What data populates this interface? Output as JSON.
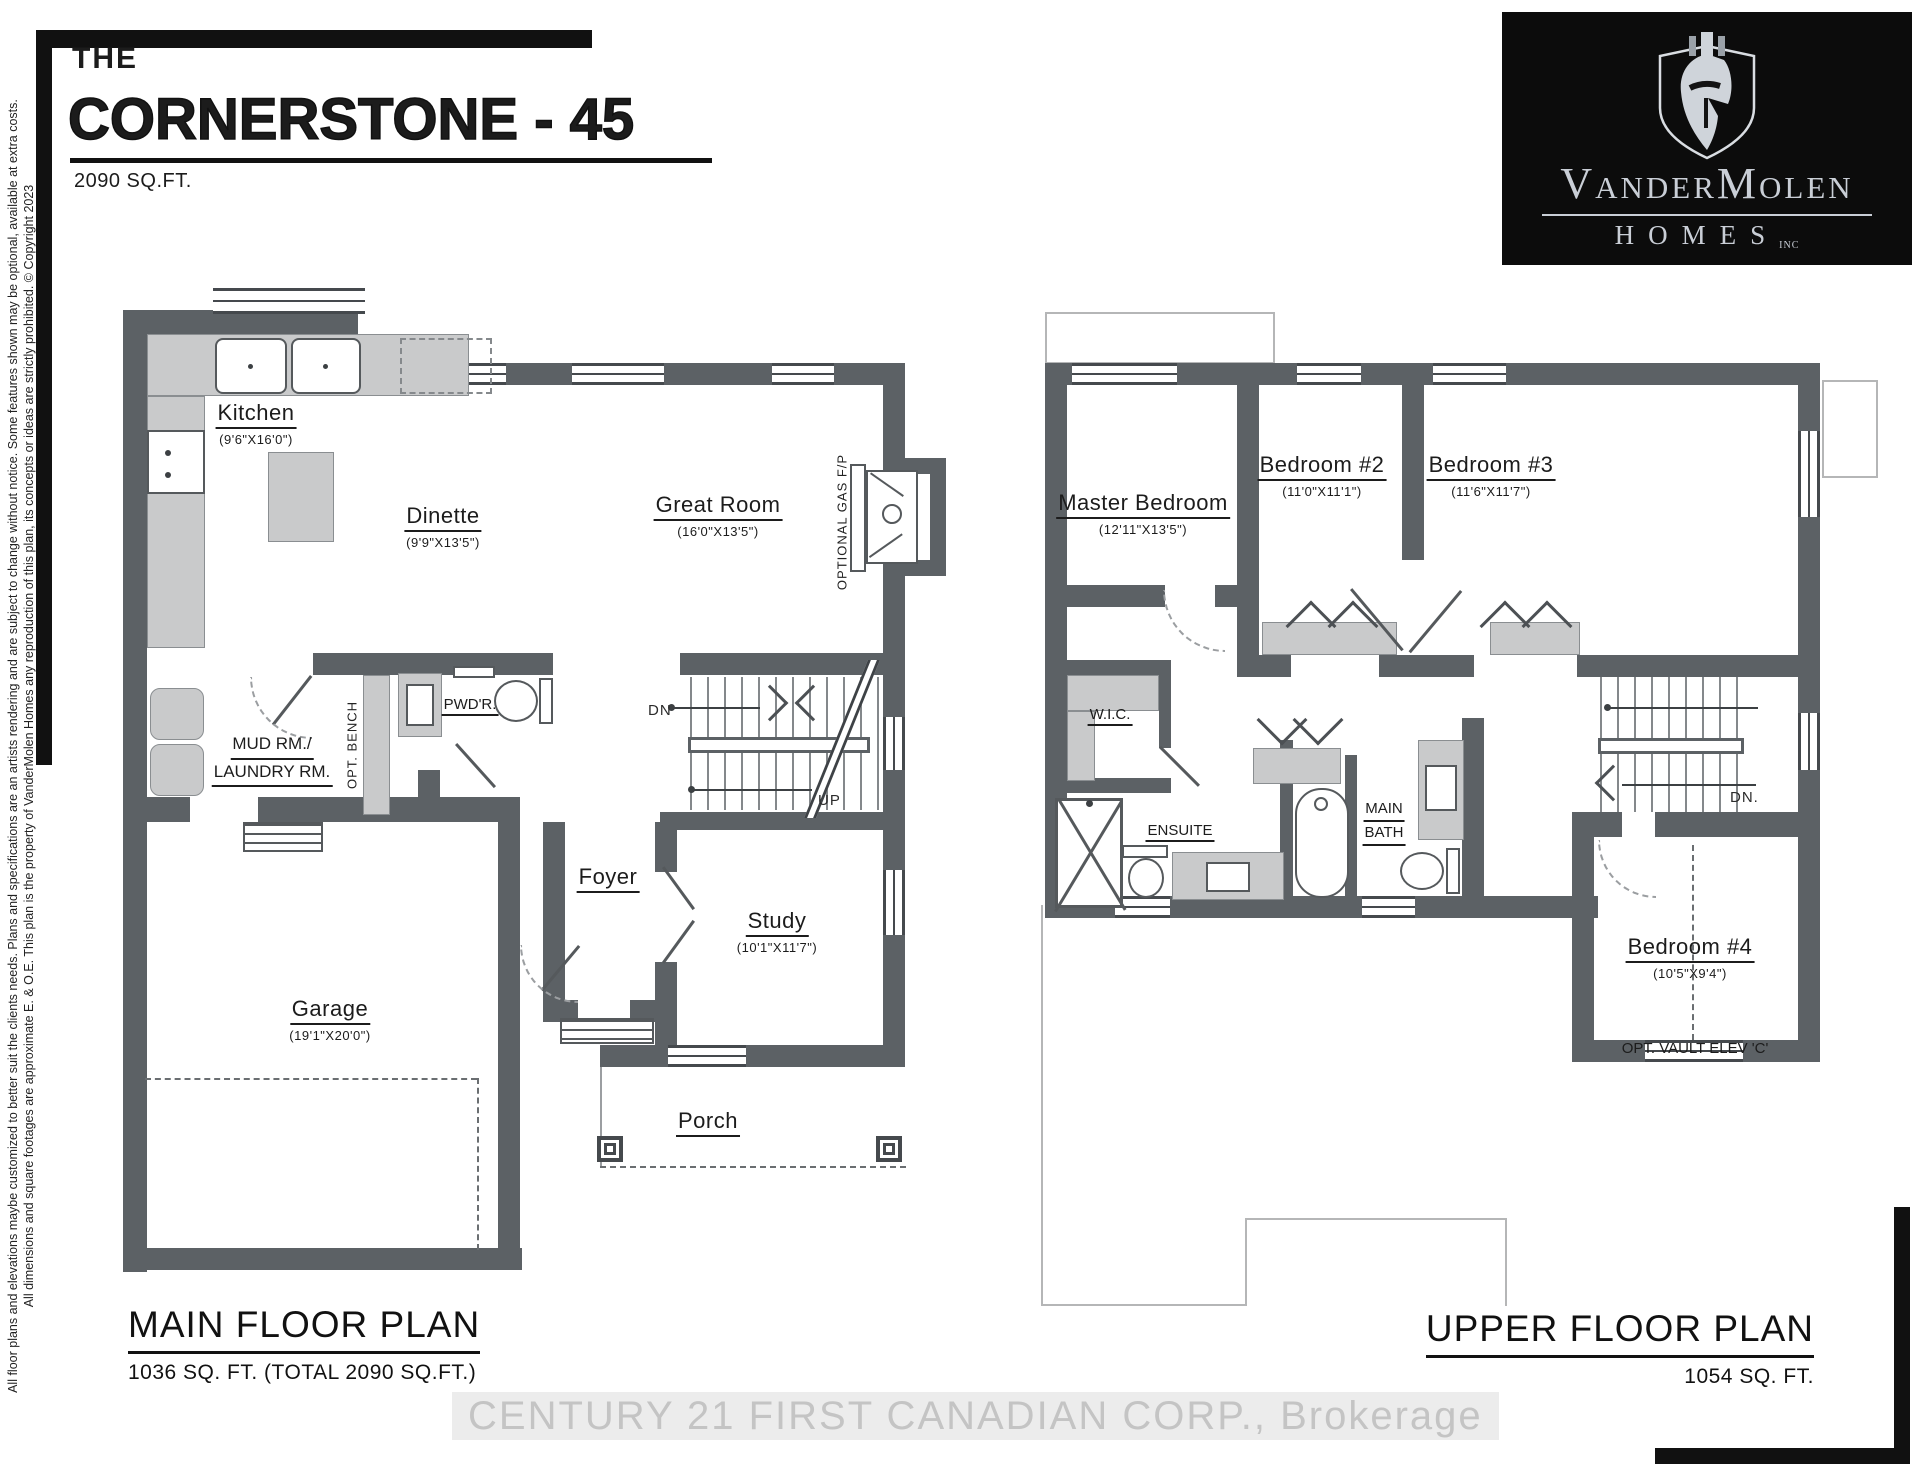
{
  "header": {
    "pre": "THE",
    "title": "CORNERSTONE - 45",
    "sqft": "2090 SQ.FT."
  },
  "logo": {
    "brand": "VanderMolen",
    "homes": "HOMES",
    "inc": "INC",
    "icon": "spartan-helmet-shield-icon",
    "bg": "#0c0c0c",
    "fg": "#c9ced6"
  },
  "disclaimer": {
    "line1": "All floor plans and elevations maybe customized to better suit the clients needs. Plans and specifications are an artists rendering and are subject to change without notice. Some features shown may be optional, available at extra costs.",
    "line2": "All dimensions and square footages are approximate E. & O.E. This plan is the property of VanderMolen Homes any reproduction of this plan, its concepts or ideas are strictly prohibited. © Copyright 2023"
  },
  "main": {
    "title": "MAIN FLOOR PLAN",
    "subtitle": "1036 SQ. FT. (TOTAL 2090 SQ.FT.)",
    "kitchen": {
      "name": "Kitchen",
      "dims": "(9'6\"X16'0\")"
    },
    "dinette": {
      "name": "Dinette",
      "dims": "(9'9\"X13'5\")"
    },
    "great_room": {
      "name": "Great Room",
      "dims": "(16'0\"X13'5\")"
    },
    "foyer": {
      "name": "Foyer"
    },
    "study": {
      "name": "Study",
      "dims": "(10'1\"X11'7\")"
    },
    "garage": {
      "name": "Garage",
      "dims": "(19'1\"X20'0\")"
    },
    "porch": {
      "name": "Porch"
    },
    "mud_line1": "MUD RM./",
    "mud_line2": "LAUNDRY RM.",
    "powder": "PWD'R.",
    "bench": "OPT. BENCH",
    "gas_fp": "OPTIONAL GAS F/P",
    "dn": "DN",
    "up": "UP"
  },
  "upper": {
    "title": "UPPER FLOOR PLAN",
    "subtitle": "1054 SQ. FT.",
    "master": {
      "name": "Master Bedroom",
      "dims": "(12'11\"X13'5\")"
    },
    "bed2": {
      "name": "Bedroom #2",
      "dims": "(11'0\"X11'1\")"
    },
    "bed3": {
      "name": "Bedroom #3",
      "dims": "(11'6\"X11'7\")"
    },
    "bed4": {
      "name": "Bedroom #4",
      "dims": "(10'5\"X9'4\")"
    },
    "wic": "W.I.C.",
    "ensuite": "ENSUITE",
    "main_bath_1": "MAIN",
    "main_bath_2": "BATH",
    "vault": "OPT. VAULT ELEV 'C'",
    "dn": "DN."
  },
  "watermark": "CENTURY 21 FIRST CANADIAN CORP., Brokerage",
  "colors": {
    "wall": "#5c6165",
    "counter": "#c9cacb",
    "logo_bg": "#0c0c0c",
    "logo_fg": "#c9ced6",
    "watermark_text": "#c4c4c4"
  }
}
